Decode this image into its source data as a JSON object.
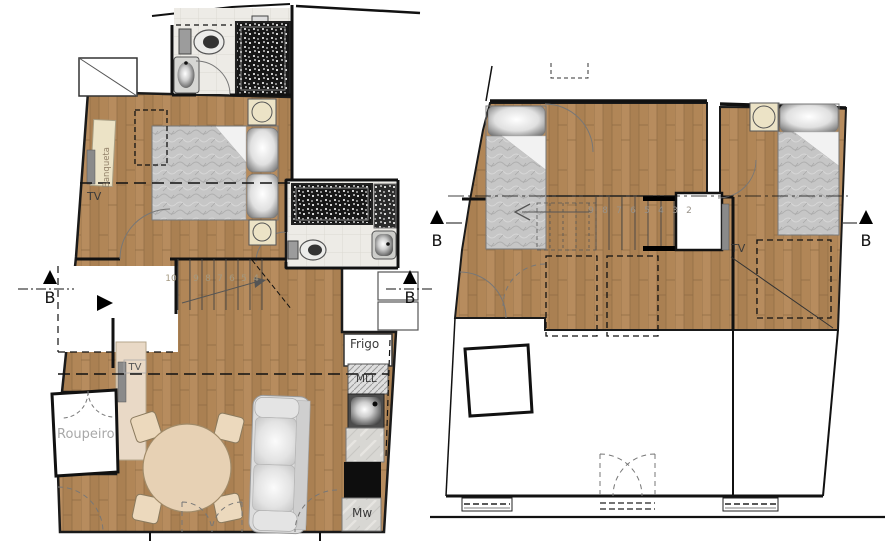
{
  "lower_plan": {
    "labels": {
      "banqueta": "Banqueta",
      "bedroom_tv": "TV",
      "living_tv": "TV",
      "wardrobe": "Roupeiro",
      "fridge": "Frigo",
      "dishwasher": "MLL",
      "microwave": "Mw"
    },
    "stair_numbers": [
      "10",
      "9",
      "8",
      "7",
      "6",
      "5",
      "4"
    ],
    "section_markers": {
      "left": "B",
      "right": "B"
    }
  },
  "upper_plan": {
    "labels": {
      "tv": "TV"
    },
    "stair_numbers": [
      "9",
      "8",
      "7",
      "6",
      "5",
      "4",
      "3",
      "2"
    ],
    "section_markers": {
      "left": "B",
      "right": "B"
    }
  },
  "colors": {
    "wood_base": "#b28758",
    "wall": "#1a1a1a",
    "duvet": "#c6c6c6",
    "cream": "#ece3c6",
    "tv_cabinet": "#e9d9c6",
    "table": "#e7d1b4",
    "chair": "#ecd9bd",
    "sofa": "#dcdcdc",
    "tile": "#edebe6",
    "mosaic": "#171717"
  }
}
